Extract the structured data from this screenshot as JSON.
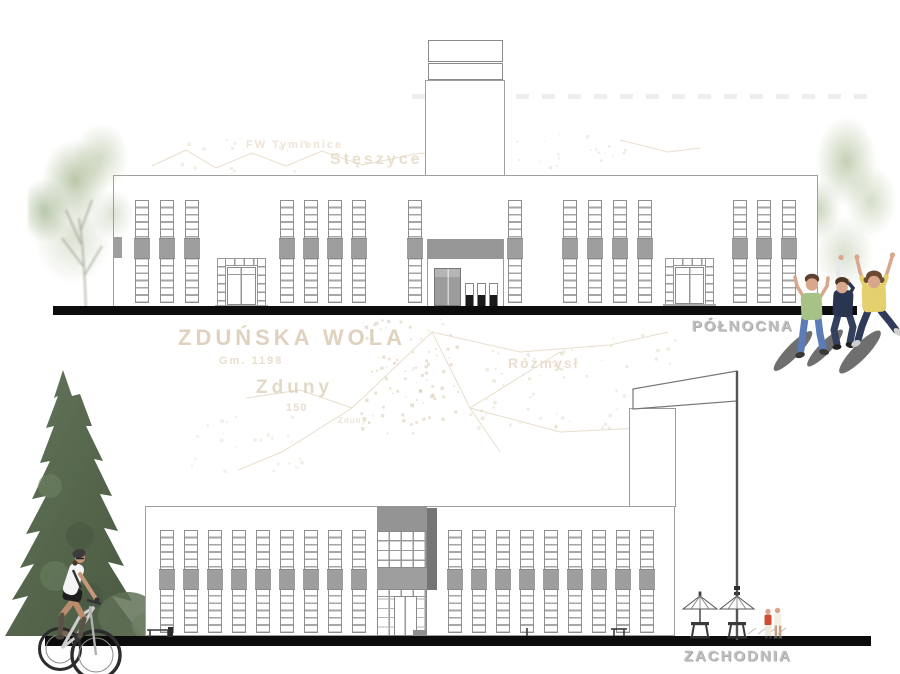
{
  "labels": {
    "north": "PÓŁNOCNA",
    "west": "ZACHODNIA"
  },
  "map_texts": [
    {
      "text": "FW Tymienice",
      "x": 246,
      "y": 139,
      "size": 11,
      "ls": 2,
      "color": "#e9decd"
    },
    {
      "text": "Stęszyce",
      "x": 330,
      "y": 151,
      "size": 16,
      "ls": 3,
      "color": "#e4d8c4"
    },
    {
      "text": "ZDUŃSKA WOLA",
      "x": 178,
      "y": 325,
      "size": 22,
      "ls": 4,
      "color": "#d8c7ae"
    },
    {
      "text": "Gm. 1198",
      "x": 219,
      "y": 355,
      "size": 11,
      "ls": 2,
      "color": "#e2d6c2"
    },
    {
      "text": "Zduny",
      "x": 256,
      "y": 377,
      "size": 19,
      "ls": 4,
      "color": "#ddd0ba"
    },
    {
      "text": "150",
      "x": 286,
      "y": 402,
      "size": 11,
      "ls": 1,
      "color": "#e2d6c2"
    },
    {
      "text": "Zduny",
      "x": 338,
      "y": 416,
      "size": 8,
      "ls": 1,
      "color": "#e8decd"
    },
    {
      "text": "Różmysł",
      "x": 508,
      "y": 355,
      "size": 14,
      "ls": 2,
      "color": "#e4d8c5"
    }
  ],
  "north_elevation": {
    "name": "elewacja północna",
    "window_columns_x": [
      135,
      160,
      185,
      280,
      304,
      328,
      352,
      408,
      508,
      563,
      588,
      613,
      638,
      733,
      757,
      782
    ],
    "column": {
      "w": 14,
      "y": 200,
      "h": 103,
      "band_y": 237,
      "band_h": 21
    }
  },
  "west_elevation": {
    "name": "elewacja zachodnia",
    "window_columns_x": [
      160,
      184,
      208,
      232,
      256,
      280,
      304,
      328,
      352,
      448,
      472,
      496,
      520,
      544,
      568,
      592,
      616,
      640
    ],
    "column": {
      "w": 14,
      "y": 530,
      "h": 103,
      "band_y": 568,
      "band_h": 21
    }
  },
  "palette": {
    "window_band": "#9e9e9e",
    "mullion": "#9a9a9a",
    "outline": "#8f8f8f",
    "ground_line": "#0c0c0c",
    "label_gray": "#bdbdbd",
    "map_ink": "#dccdb6",
    "kid_shirt_green": "#a6c287",
    "kid_shirt_navy": "#2a3550",
    "kid_shirt_yellow": "#e5d06e"
  },
  "map_dot_clusters": [
    {
      "x": 358,
      "y": 318,
      "w": 100,
      "h": 115,
      "n": 95,
      "color": "#d9c9b0",
      "op": 0.55
    },
    {
      "x": 468,
      "y": 348,
      "w": 95,
      "h": 80,
      "n": 35,
      "color": "#ddd0ba",
      "op": 0.45
    },
    {
      "x": 185,
      "y": 415,
      "w": 120,
      "h": 55,
      "n": 25,
      "color": "#e0d4c0",
      "op": 0.4
    },
    {
      "x": 560,
      "y": 330,
      "w": 115,
      "h": 100,
      "n": 32,
      "color": "#ddd0ba",
      "op": 0.4
    },
    {
      "x": 468,
      "y": 133,
      "w": 175,
      "h": 35,
      "n": 24,
      "color": "#e6dbca",
      "op": 0.5
    },
    {
      "x": 160,
      "y": 138,
      "w": 150,
      "h": 35,
      "n": 18,
      "color": "#e8ddcc",
      "op": 0.5
    }
  ]
}
